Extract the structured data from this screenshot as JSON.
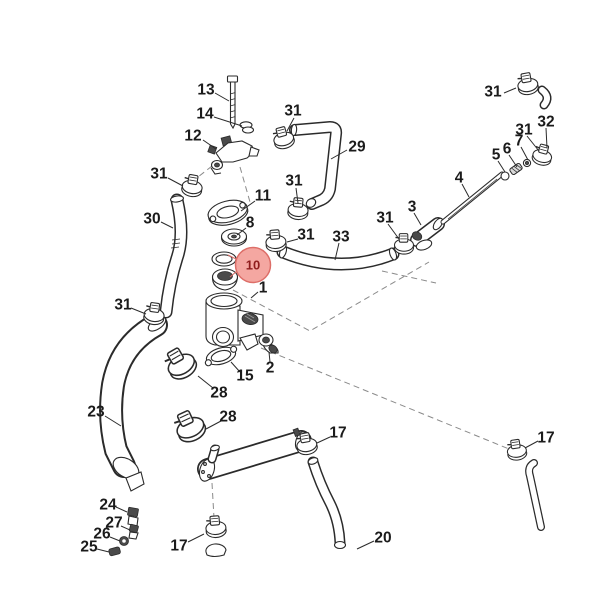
{
  "diagram": {
    "background": "#ffffff",
    "ink_color": "#2b2b2b",
    "label_color": "#1b1b1b",
    "highlight": {
      "text": "10",
      "x": 253,
      "y": 265,
      "r": 17.5,
      "fill": "#f4a7a1",
      "stroke": "#dd6e68",
      "text_color": "#8f1d1d",
      "leaders": [
        [
          236,
          259,
          228,
          255
        ],
        [
          237,
          271,
          230,
          277
        ]
      ]
    },
    "labels": [
      {
        "text": "13",
        "x": 206,
        "y": 90,
        "leader": [
          215,
          93,
          229,
          101
        ]
      },
      {
        "text": "14",
        "x": 205,
        "y": 114,
        "leader": [
          214,
          117,
          242,
          126
        ]
      },
      {
        "text": "12",
        "x": 193,
        "y": 136,
        "leader": [
          203,
          140,
          216,
          149
        ]
      },
      {
        "text": "31",
        "x": 293,
        "y": 111,
        "leader": [
          294,
          118,
          287,
          131
        ]
      },
      {
        "text": "29",
        "x": 357,
        "y": 147,
        "leader": [
          347,
          150,
          331,
          159
        ]
      },
      {
        "text": "31",
        "x": 159,
        "y": 174,
        "leader": [
          168,
          178,
          183,
          186
        ]
      },
      {
        "text": "11",
        "x": 263,
        "y": 196,
        "leader": [
          255,
          201,
          241,
          211
        ]
      },
      {
        "text": "30",
        "x": 152,
        "y": 219,
        "leader": [
          161,
          222,
          173,
          228
        ]
      },
      {
        "text": "8",
        "x": 250,
        "y": 223,
        "leader": [
          246,
          228,
          237,
          235
        ]
      },
      {
        "text": "31",
        "x": 294,
        "y": 181,
        "leader": [
          296,
          188,
          298,
          203
        ]
      },
      {
        "text": "31",
        "x": 493,
        "y": 92,
        "leader": [
          504,
          93,
          516,
          88
        ]
      },
      {
        "text": "32",
        "x": 546,
        "y": 122,
        "leader": [
          546,
          128,
          547,
          148
        ]
      },
      {
        "text": "31",
        "x": 524,
        "y": 130,
        "leader": [
          527,
          136,
          539,
          151
        ]
      },
      {
        "text": "7",
        "x": 519,
        "y": 141,
        "leader": [
          521,
          147,
          528,
          160
        ]
      },
      {
        "text": "6",
        "x": 507,
        "y": 149,
        "leader": [
          509,
          155,
          517,
          167
        ]
      },
      {
        "text": "5",
        "x": 496,
        "y": 155,
        "leader": [
          498,
          161,
          505,
          172
        ]
      },
      {
        "text": "4",
        "x": 459,
        "y": 178,
        "leader": [
          462,
          184,
          469,
          197
        ]
      },
      {
        "text": "3",
        "x": 412,
        "y": 207,
        "leader": [
          414,
          213,
          421,
          225
        ]
      },
      {
        "text": "31",
        "x": 385,
        "y": 218,
        "leader": [
          388,
          224,
          399,
          239
        ]
      },
      {
        "text": "31",
        "x": 306,
        "y": 235,
        "leader": [
          298,
          239,
          287,
          242
        ]
      },
      {
        "text": "33",
        "x": 341,
        "y": 237,
        "leader": [
          339,
          243,
          335,
          260
        ]
      },
      {
        "text": "1",
        "x": 263,
        "y": 288,
        "leader": [
          258,
          292,
          251,
          298
        ]
      },
      {
        "text": "31",
        "x": 123,
        "y": 305,
        "leader": [
          131,
          308,
          146,
          314
        ]
      },
      {
        "text": "2",
        "x": 270,
        "y": 368,
        "leader": [
          270,
          362,
          269,
          352
        ]
      },
      {
        "text": "15",
        "x": 245,
        "y": 376,
        "leader": [
          240,
          372,
          231,
          362
        ]
      },
      {
        "text": "28",
        "x": 219,
        "y": 393,
        "leader": [
          213,
          388,
          198,
          376
        ]
      },
      {
        "text": "28",
        "x": 228,
        "y": 417,
        "leader": [
          221,
          421,
          206,
          429
        ]
      },
      {
        "text": "23",
        "x": 96,
        "y": 412,
        "leader": [
          105,
          416,
          121,
          426
        ]
      },
      {
        "text": "17",
        "x": 338,
        "y": 433,
        "leader": [
          330,
          437,
          317,
          443
        ]
      },
      {
        "text": "20",
        "x": 383,
        "y": 538,
        "leader": [
          374,
          541,
          357,
          549
        ]
      },
      {
        "text": "17",
        "x": 179,
        "y": 546,
        "leader": [
          188,
          542,
          204,
          534
        ]
      },
      {
        "text": "17",
        "x": 546,
        "y": 438,
        "leader": [
          538,
          441,
          525,
          448
        ]
      },
      {
        "text": "24",
        "x": 108,
        "y": 505,
        "leader": [
          116,
          507,
          127,
          512
        ]
      },
      {
        "text": "27",
        "x": 114,
        "y": 523,
        "leader": [
          121,
          526,
          130,
          530
        ]
      },
      {
        "text": "26",
        "x": 102,
        "y": 534,
        "leader": [
          110,
          537,
          120,
          541
        ]
      },
      {
        "text": "25",
        "x": 89,
        "y": 547,
        "leader": [
          97,
          549,
          109,
          552
        ]
      }
    ],
    "clamps": [
      {
        "x": 284,
        "y": 140,
        "rot": -15,
        "s": 1
      },
      {
        "x": 298,
        "y": 211,
        "rot": 5,
        "s": 1
      },
      {
        "x": 276,
        "y": 243,
        "rot": -5,
        "s": 1
      },
      {
        "x": 404,
        "y": 246,
        "rot": 0,
        "s": 0.95
      },
      {
        "x": 528,
        "y": 86,
        "rot": -10,
        "s": 1
      },
      {
        "x": 542,
        "y": 157,
        "rot": 15,
        "s": 0.95
      },
      {
        "x": 192,
        "y": 188,
        "rot": 10,
        "s": 1
      },
      {
        "x": 154,
        "y": 316,
        "rot": 8,
        "s": 1
      },
      {
        "x": 182,
        "y": 366,
        "rot": -30,
        "s": 1.4
      },
      {
        "x": 191,
        "y": 429,
        "rot": -25,
        "s": 1.4
      },
      {
        "x": 307,
        "y": 446,
        "rot": -10,
        "s": 1
      },
      {
        "x": 216,
        "y": 529,
        "rot": -5,
        "s": 1
      },
      {
        "x": 517,
        "y": 452,
        "rot": -8,
        "s": 0.95
      }
    ]
  }
}
